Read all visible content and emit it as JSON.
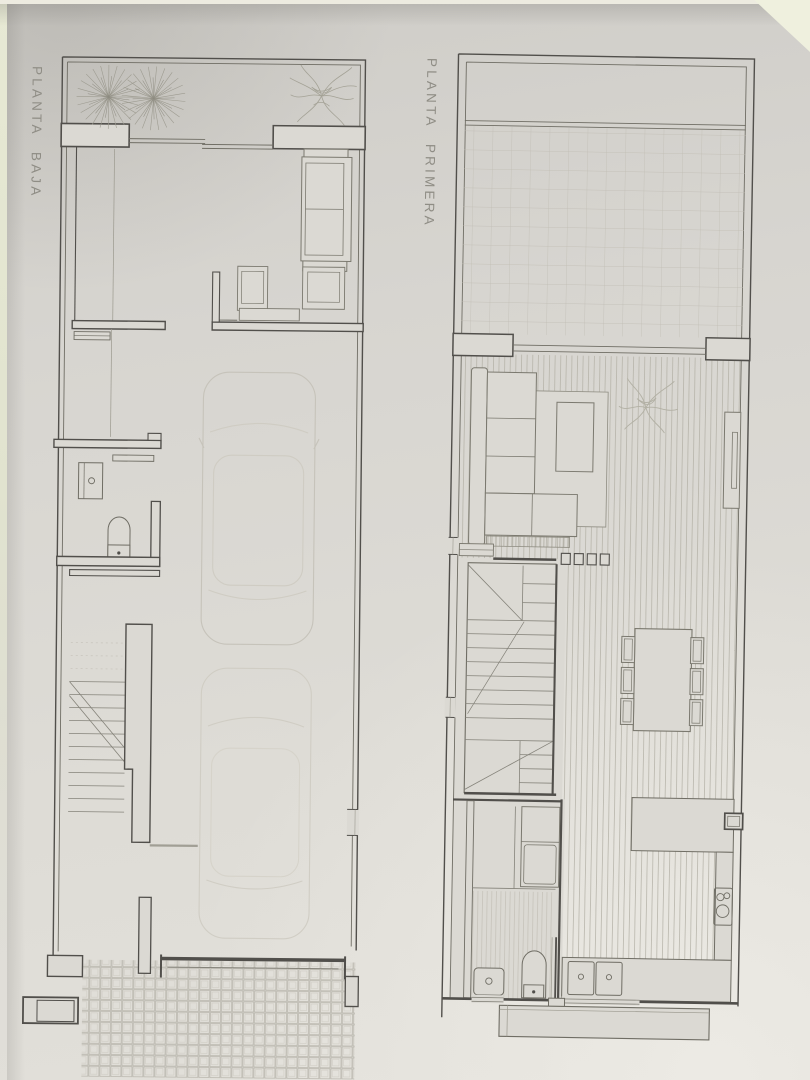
{
  "sheet": {
    "type": "architectural-floor-plans-photo"
  },
  "plans": [
    {
      "id": "planta-baja",
      "label": "PLANTA BAJA"
    },
    {
      "id": "planta-primera",
      "label": "PLANTA PRIMERA"
    }
  ],
  "colors": {
    "paper": "#dbd9d3",
    "paper_edge": "#e7e9d4",
    "wall_line": "#514f4b",
    "medium_line": "#6f6d64",
    "light_line": "#9b998e",
    "faint_line": "#c7c4bb",
    "label_text": "#8f8d85"
  }
}
